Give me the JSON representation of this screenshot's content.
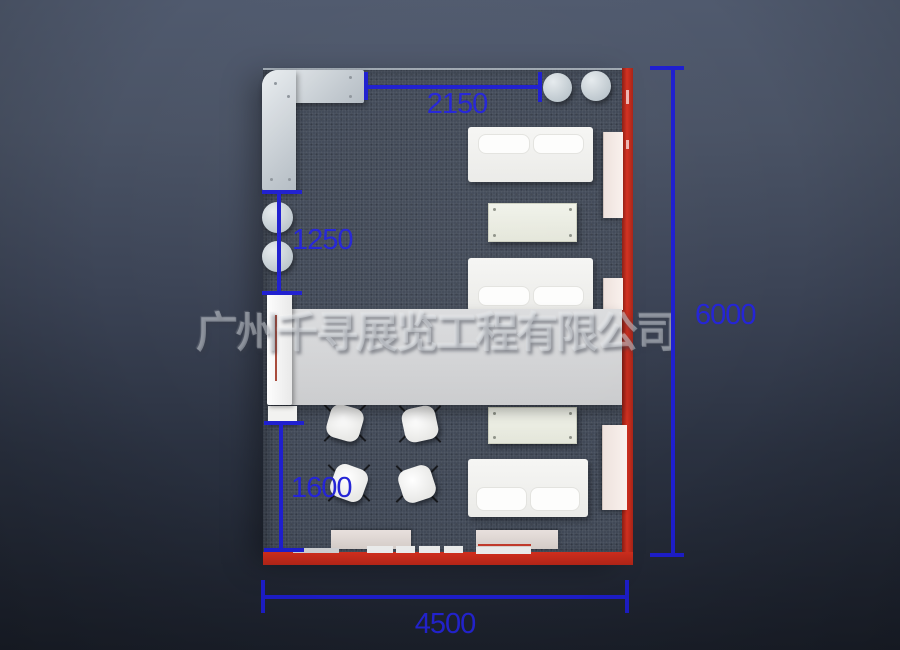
{
  "watermark": {
    "text": "广州千寻展览工程有限公司"
  },
  "dimensions": {
    "top_width": {
      "label": "2150"
    },
    "left_upper": {
      "label": "1250"
    },
    "left_lower": {
      "label": "1600"
    },
    "right_height": {
      "label": "6000"
    },
    "bottom_width": {
      "label": "4500"
    }
  },
  "colors": {
    "dimension_blue": "#2424d6",
    "wall_red": "#c42a1a",
    "carpet_gray": "#414957",
    "counter_band_gray": "#d4d5d7",
    "furniture_white": "#f4f4f2",
    "background_top": "#505a6e",
    "background_bottom": "#1b202b"
  }
}
